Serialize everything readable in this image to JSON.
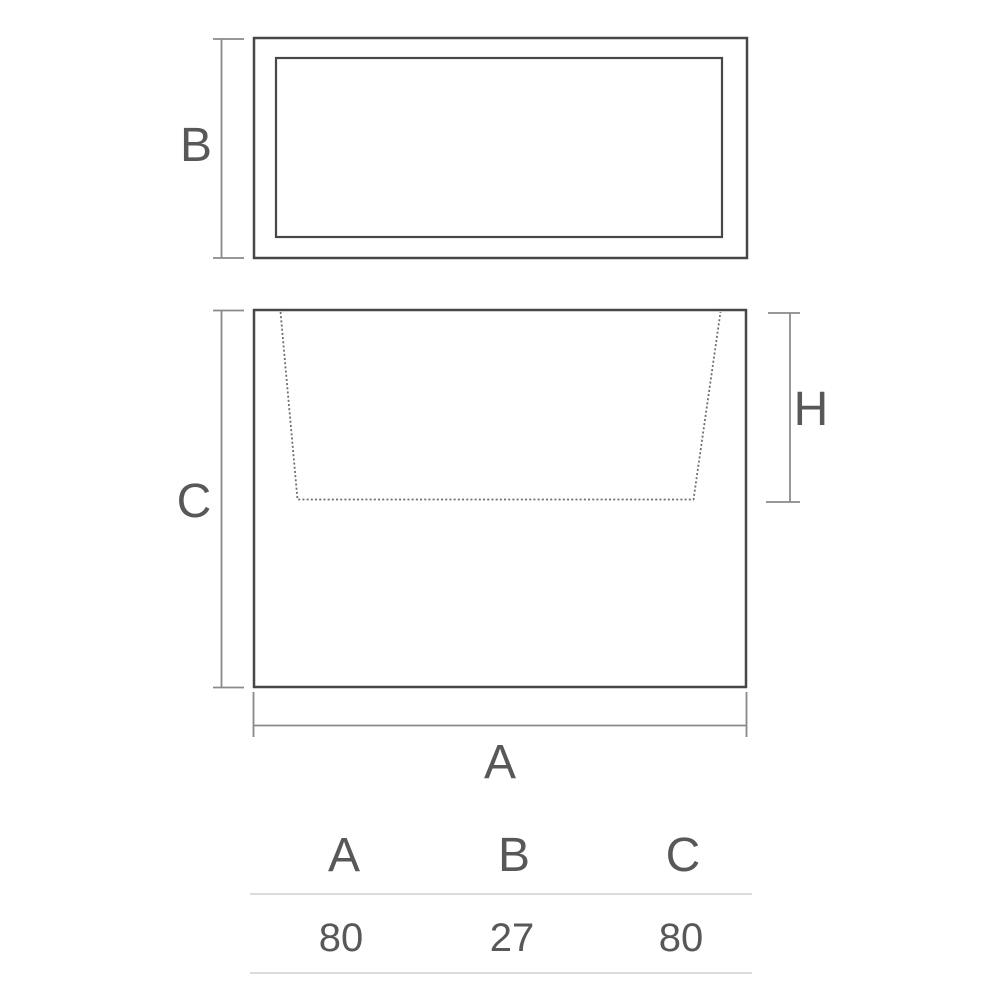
{
  "diagram_type": "product-dimension-drawing",
  "dimension_labels": {
    "width": "A",
    "depth": "B",
    "height": "C",
    "inner_depth": "H"
  },
  "views": {
    "top_view": "plan view with inner rim rectangle",
    "front_view": "elevation with dashed inner cavity taper"
  },
  "table": {
    "headers": [
      "A",
      "B",
      "C"
    ],
    "values": [
      "80",
      "27",
      "80"
    ]
  },
  "colors": {
    "background": "#ffffff",
    "outline": "#474747",
    "dimension_line": "#8a8a8a",
    "dashed_line": "#6e6e6e",
    "text": "#57585a",
    "table_rule": "#cfcfcf"
  }
}
